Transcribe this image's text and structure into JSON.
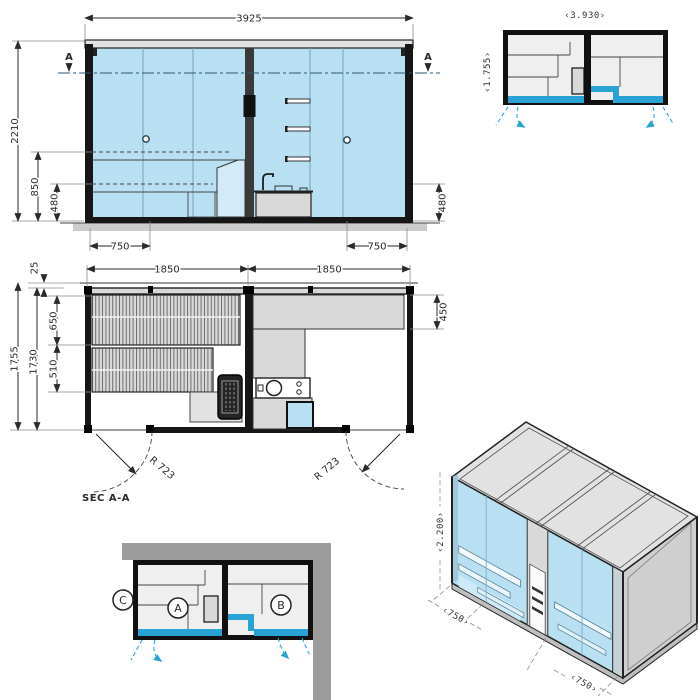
{
  "colors": {
    "line": "#222222",
    "glass": "#b9e0f2",
    "glass_light": "#d3ebf8",
    "accent": "#29a3d6",
    "panel_gray": "#e2e2e2",
    "mid_gray": "#d9d9d9",
    "wall_gray": "#9c9c9c",
    "interior_gray": "#efefef",
    "ground_gray": "#cccccc",
    "dark": "#161616"
  },
  "elevation": {
    "dims": {
      "width_total": "3925",
      "height_total": "2210",
      "bench_height": "850",
      "plinth_left": "480",
      "plinth_right": "480",
      "door_left": "750",
      "door_right": "750"
    },
    "section_marker_left": "A",
    "section_marker_right": "A"
  },
  "mini_plan": {
    "dims": {
      "width": "‹3.930›",
      "depth": "‹1.755›"
    }
  },
  "floor_plan": {
    "dims": {
      "room_left_width": "1850",
      "room_right_width": "1850",
      "depth_total": "1755",
      "depth_inner": "1730",
      "roof_offset": "25",
      "bench_upper_depth": "650",
      "bench_lower_depth": "510",
      "counter_depth": "450",
      "door_swing_left": "R 723",
      "door_swing_right": "R 723"
    },
    "section_label": "SEC A-A"
  },
  "corner_plan": {
    "labels": {
      "side": "C",
      "left_room": "A",
      "right_room": "B"
    }
  },
  "isometric": {
    "dims": {
      "height": "‹2.200›",
      "module_left": "‹750›",
      "module_right": "‹750›"
    }
  }
}
